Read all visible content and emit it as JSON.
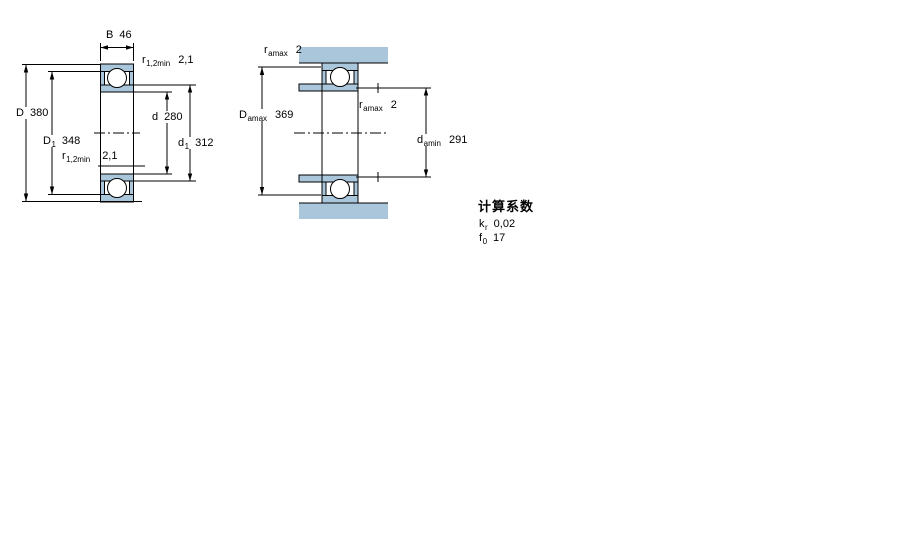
{
  "colors": {
    "bearing_fill": "#a9c6da",
    "line_color": "#000000",
    "background": "#ffffff"
  },
  "left_view": {
    "width_dim": {
      "symbol": "B",
      "value": "46"
    },
    "chamfer_top": {
      "symbol": "r",
      "subscript": "1,2min",
      "value": "2,1"
    },
    "outer_diameter": {
      "symbol": "D",
      "value": "380"
    },
    "bore_diameter": {
      "symbol": "d",
      "value": "280"
    },
    "outer_shoulder": {
      "symbol": "D",
      "subscript": "1",
      "value": "348"
    },
    "inner_shoulder": {
      "symbol": "d",
      "subscript": "1",
      "value": "312"
    },
    "chamfer_bottom": {
      "symbol": "r",
      "subscript": "1,2min",
      "value": "2,1"
    }
  },
  "right_view": {
    "fillet_top": {
      "symbol": "r",
      "subscript": "amax",
      "value": "2"
    },
    "housing_abutment": {
      "symbol": "D",
      "subscript": "amax",
      "value": "369"
    },
    "fillet_inner": {
      "symbol": "r",
      "subscript": "amax",
      "value": "2"
    },
    "shaft_abutment": {
      "symbol": "d",
      "subscript": "amin",
      "value": "291"
    }
  },
  "calculation_factors": {
    "title": "计算系数",
    "rows": [
      {
        "symbol": "k",
        "subscript": "r",
        "value": "0,02"
      },
      {
        "symbol": "f",
        "subscript": "0",
        "value": "17"
      }
    ]
  }
}
